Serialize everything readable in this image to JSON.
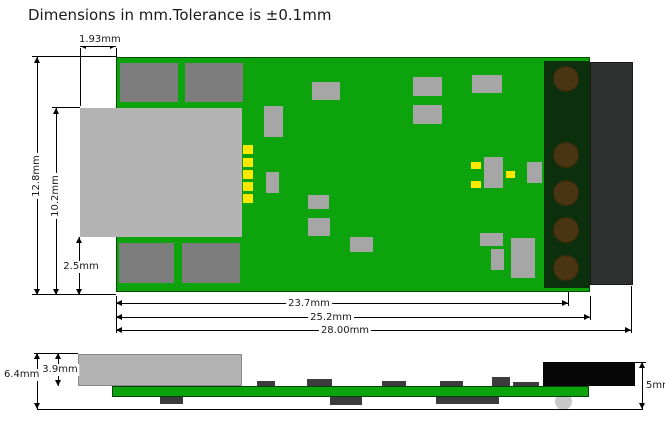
{
  "title": "Dimensions in mm.Tolerance is ±0.1mm",
  "views": {
    "top": {
      "dims": {
        "connector_overhang": "1.93mm",
        "board_width": "12.8mm",
        "connector_span": "10.2mm",
        "bottom_margin": "2.5mm",
        "to_pin_centers": "23.7mm",
        "board_length": "25.2mm",
        "overall_length": "28.00mm"
      }
    },
    "side": {
      "dims": {
        "overall_height": "6.4mm",
        "connector_height": "3.9mm",
        "terminal_height": "5mm"
      }
    }
  },
  "colors": {
    "background": "#FFFFFF",
    "pcb_green": "#0CA30C",
    "pad_dark_gray": "#7D7D7D",
    "usb_connector_gray": "#B3B3B3",
    "component_gray": "#A6A6A6",
    "solder_pad_yellow": "#FFE800",
    "terminal_block_dark_green": "#0C300C",
    "pin_hole_brown": "#4A3512",
    "housing_dark_gray": "#2F3131",
    "terminal_side_black": "#060606",
    "dimension_line_black": "#000000"
  }
}
